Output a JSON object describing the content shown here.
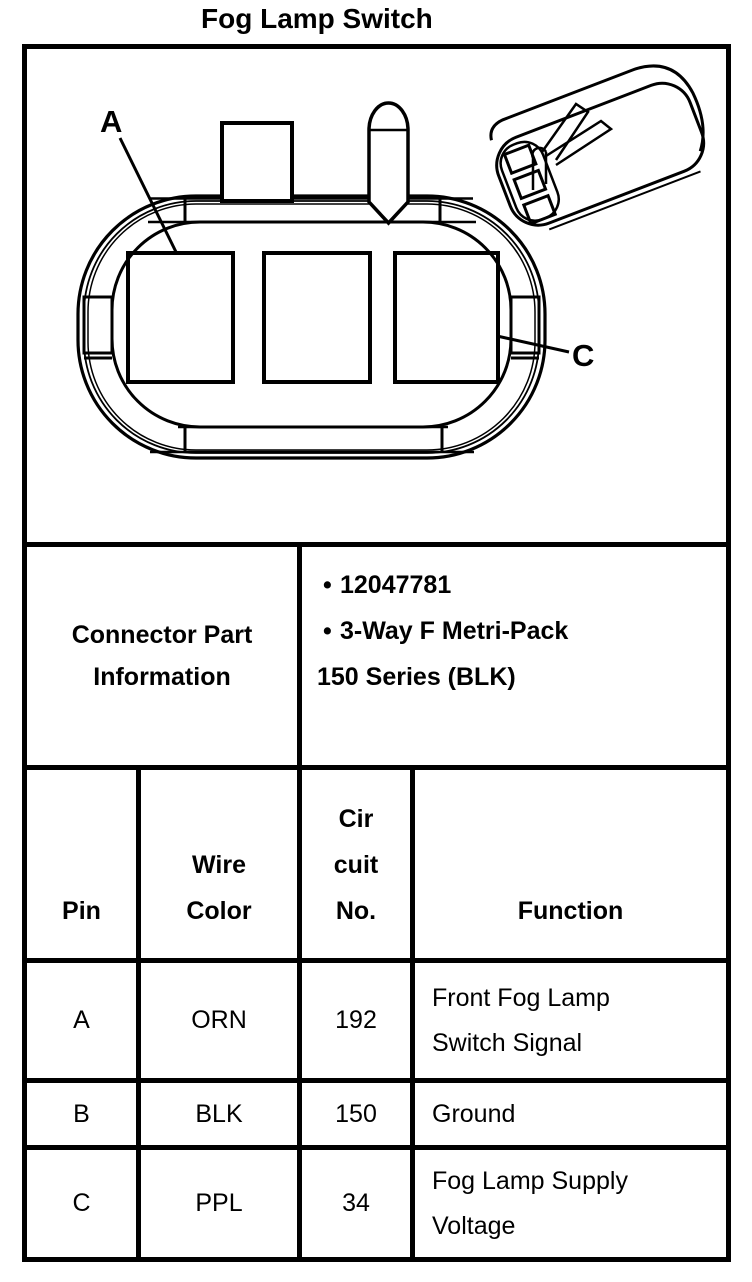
{
  "title": "Fog Lamp Switch",
  "diagram": {
    "labels": {
      "a": "A",
      "c": "C"
    }
  },
  "part_info": {
    "label_lines": [
      "Connector Part",
      "Information"
    ],
    "bullet_glyph": "•",
    "bullet_items": [
      "12047781",
      "3-Way F Metri-Pack"
    ],
    "continuation_line": "150 Series (BLK)"
  },
  "pin_table": {
    "headers": {
      "pin": "Pin",
      "wire_color_lines": [
        "Wire",
        "Color"
      ],
      "circuit_lines": [
        "Cir",
        "cuit",
        "No."
      ],
      "function": "Function"
    },
    "rows": [
      {
        "pin": "A",
        "wire_color": "ORN",
        "circuit_no": "192",
        "function_lines": [
          "Front Fog Lamp",
          "Switch Signal"
        ]
      },
      {
        "pin": "B",
        "wire_color": "BLK",
        "circuit_no": "150",
        "function_lines": [
          "Ground"
        ]
      },
      {
        "pin": "C",
        "wire_color": "PPL",
        "circuit_no": "34",
        "function_lines": [
          "Fog Lamp Supply",
          "Voltage"
        ]
      }
    ]
  },
  "colors": {
    "ink": "#000000",
    "background": "#ffffff"
  }
}
